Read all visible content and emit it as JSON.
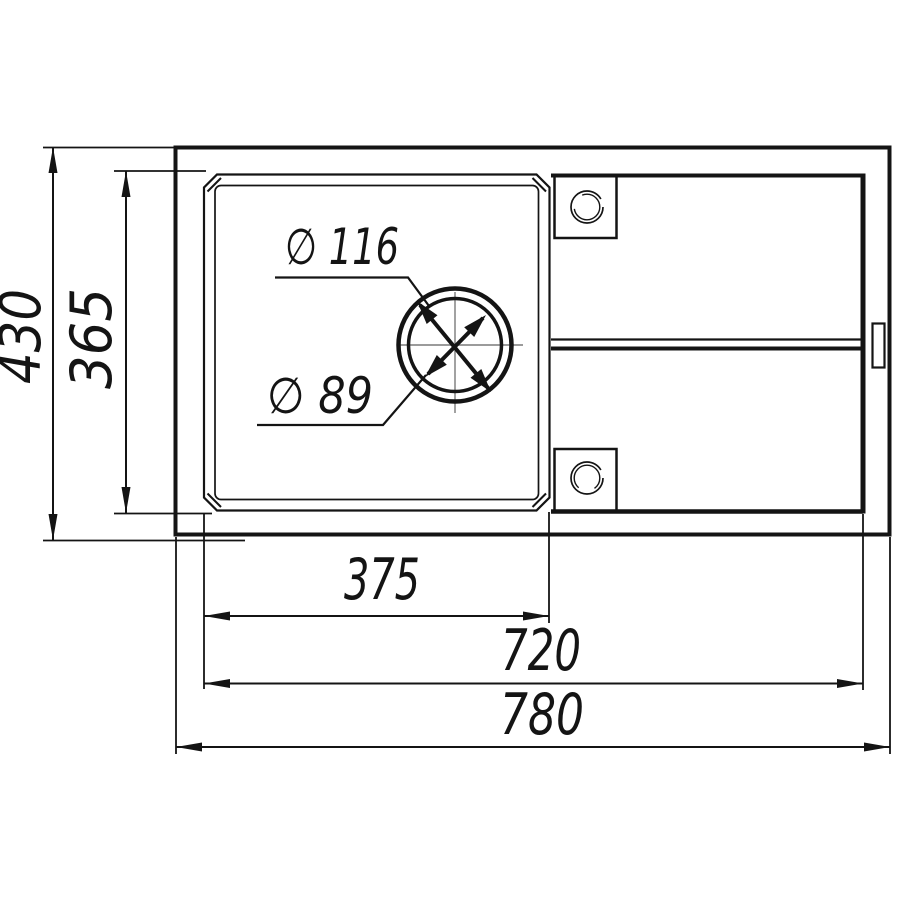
{
  "drawing": {
    "title": "sink-top-view-technical-drawing",
    "dimensions": {
      "overall_width": {
        "label": "780"
      },
      "inner_width": {
        "label": "720"
      },
      "bowl_width": {
        "label": "375"
      },
      "overall_depth": {
        "label": "430"
      },
      "bowl_depth": {
        "label": "365"
      },
      "drain_outer_diameter": {
        "label": "∅ 116"
      },
      "drain_inner_diameter": {
        "label": "∅ 89"
      }
    },
    "colors": {
      "line": "#141414",
      "background": "#ffffff",
      "centerline": "#7a7a7a"
    }
  }
}
